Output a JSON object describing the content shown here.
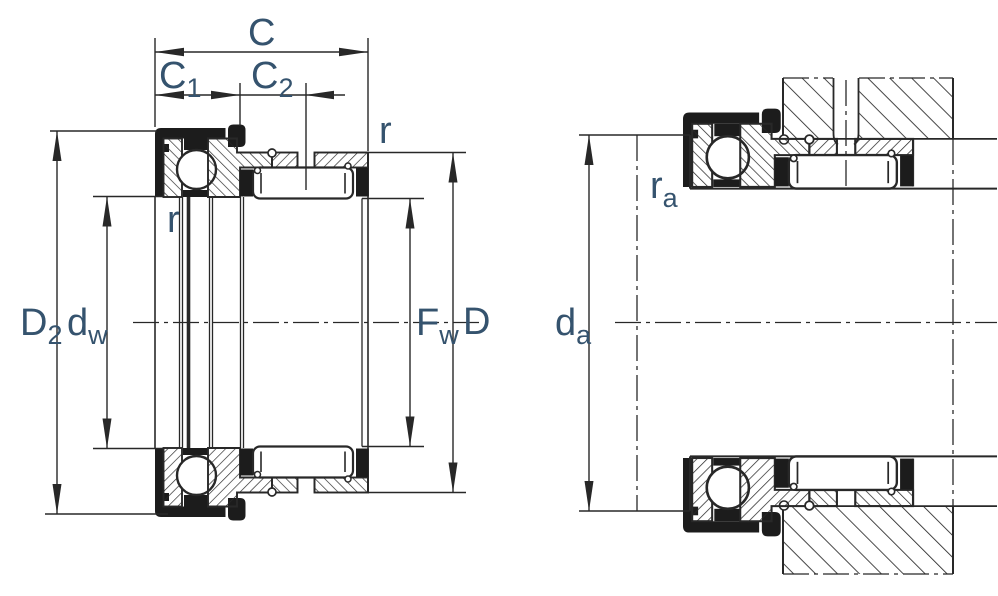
{
  "diagram": {
    "description": "Combined needle roller / axial ball bearing cross-section drawing, free state (left) and mounted with shaft and housing (right)",
    "labels": {
      "width_total": "C",
      "width_c1": {
        "main": "C",
        "sub": "1"
      },
      "width_c2": {
        "main": "C",
        "sub": "2"
      },
      "chamfer_outer": "r",
      "chamfer_inner": "r",
      "shield_outside_dia": {
        "main": "D",
        "sub": "2"
      },
      "washer_bore_dia": {
        "main": "d",
        "sub": "w"
      },
      "needle_inscribed_dia": {
        "main": "F",
        "sub": "w"
      },
      "outside_dia": "D",
      "mounted_fillet_radius": {
        "main": "r",
        "sub": "a"
      },
      "shoulder_dia": {
        "main": "d",
        "sub": "a"
      }
    },
    "colors": {
      "line": "#282828",
      "ink": "#1c1c1c",
      "label": "#35536e",
      "background": "#ffffff"
    }
  }
}
